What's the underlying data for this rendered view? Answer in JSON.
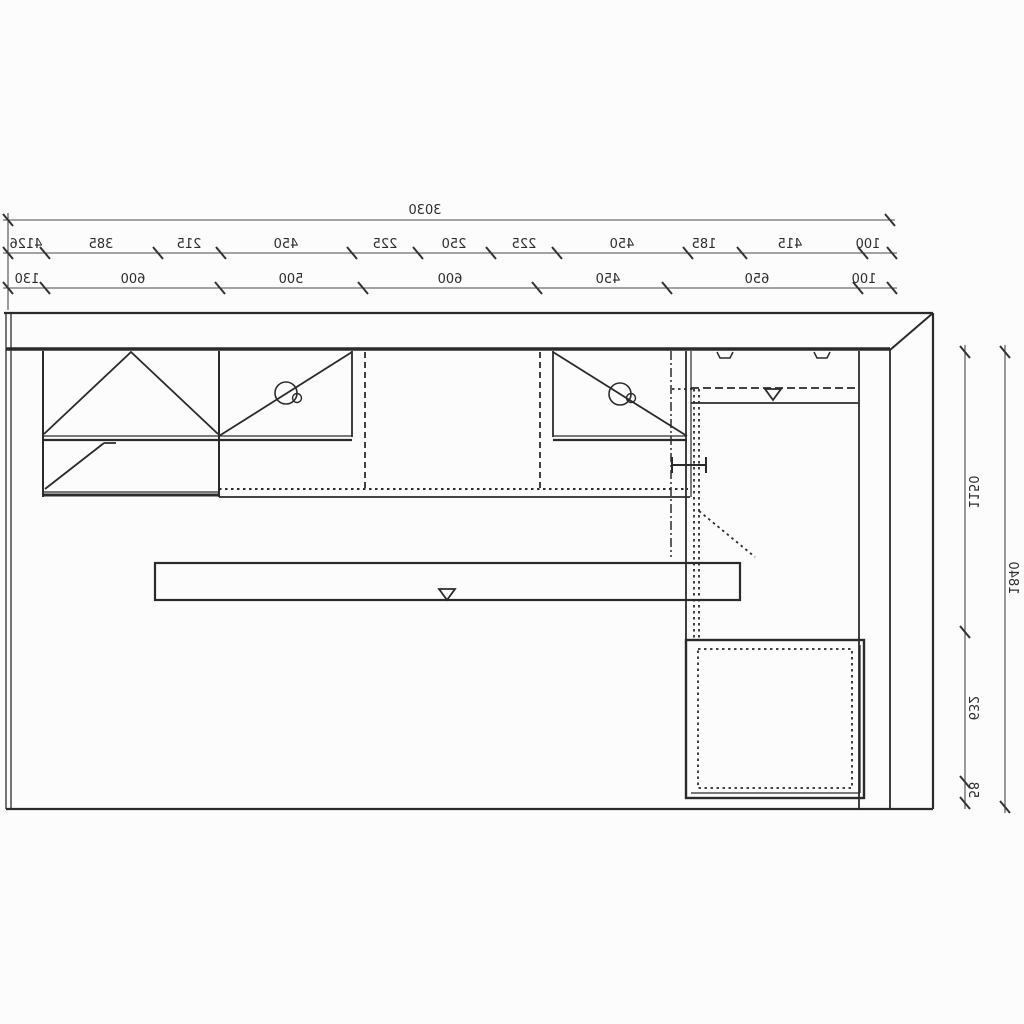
{
  "document": {
    "kind": "cad-kitchen-plan-scan",
    "note": "horizontally mirrored technical drawing, plan of kitchen run with dimension chains",
    "background_color": "#fcfcfc",
    "line_color": "#2b2b2b",
    "dim_line_color": "#4a4a4a",
    "text_color": "#2d2d2d"
  },
  "dims": {
    "total": "3030",
    "upper": [
      "4126",
      "385",
      "215",
      "450",
      "225",
      "250",
      "225",
      "450",
      "185",
      "415",
      "100"
    ],
    "lower": [
      "130",
      "600",
      "500",
      "600",
      "450",
      "650",
      "100"
    ],
    "right_inner": [
      "1150",
      "632",
      "58"
    ],
    "right_outer": "1840"
  },
  "symbols": {
    "door_swing_peak": "double door swing triangle",
    "door_swing_diagonal_with_knob": "door swing diagonal with round knob",
    "shelf_triangle": "open nabla triangle marker",
    "hinge_clips": "two hinge clips on top wall cabinet",
    "hidden_lines": "dotted / dashed hidden edges",
    "wall_mitre": "mitred wall corner top-right"
  }
}
